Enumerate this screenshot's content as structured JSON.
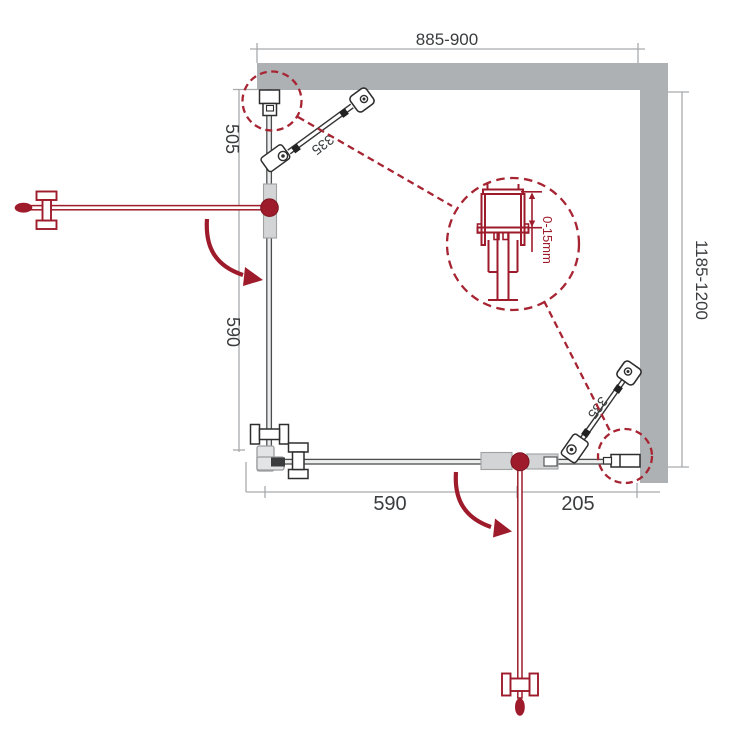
{
  "diagram": {
    "kind": "shower-enclosure-corner-installation-drawing",
    "labels": {
      "width_top": "885-900",
      "height_right": "1185-1200",
      "left_upper": "505",
      "left_lower": "590",
      "bottom_left": "590",
      "bottom_right": "205",
      "brace_top": "335",
      "brace_bottom": "335",
      "detail_adjustment": "0-15mm"
    },
    "colors": {
      "wall_gray": "#aeb1b3",
      "drawing_line": "#3a3c3e",
      "dimension_gray": "#a8aaac",
      "accent_red": "#9e1b2b",
      "dashed_red": "#a72433",
      "profile_light_gray": "#d2d4d5"
    }
  }
}
